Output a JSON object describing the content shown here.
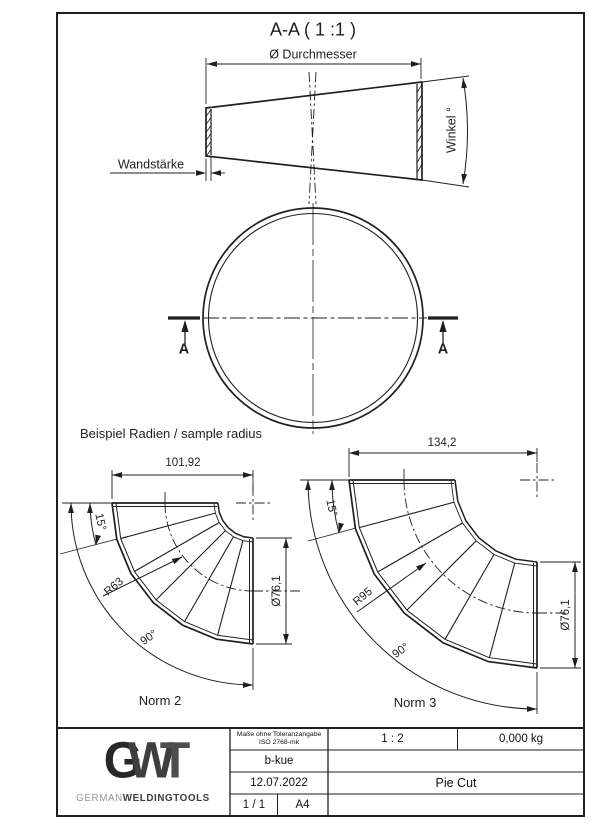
{
  "drawing": {
    "section_title": "A-A ( 1 :1 )",
    "sample_heading": "Beispiel Radien / sample radius"
  },
  "section_view": {
    "diameter_label": "Ø Durchmesser",
    "wall_thickness_label": "Wandstärke",
    "angle_label": "Winkel °"
  },
  "plan_view": {
    "section_marker": "A"
  },
  "samples": {
    "norm2": {
      "name": "Norm 2",
      "width": "101,92",
      "segment_angle": "15°",
      "bend_radius": "R63",
      "bend_angle": "90°",
      "tube_diameter": "Ø76,1"
    },
    "norm3": {
      "name": "Norm 3",
      "width": "134,2",
      "segment_angle": "15°",
      "bend_radius": "R95",
      "bend_angle": "90°",
      "tube_diameter": "Ø76,1"
    }
  },
  "title_block": {
    "logo_g": "G",
    "logo_w": "W",
    "logo_t": "T",
    "brand_light": "GERMAN",
    "brand_bold": "WELDINGTOOLS",
    "tolerance_note_line1": "Maße ohne Toleranzangabe",
    "tolerance_note_line2": "ISO 2768-mk",
    "author": "b-kue",
    "date": "12.07.2022",
    "sheet": "1 / 1",
    "paper_format": "A4",
    "scale": "1 : 2",
    "weight": "0,000 kg",
    "part_title": "Pie Cut"
  },
  "colors": {
    "line": "#1f1f1f",
    "logo_dark": "#3a3a3a",
    "logo_light": "#999999"
  }
}
